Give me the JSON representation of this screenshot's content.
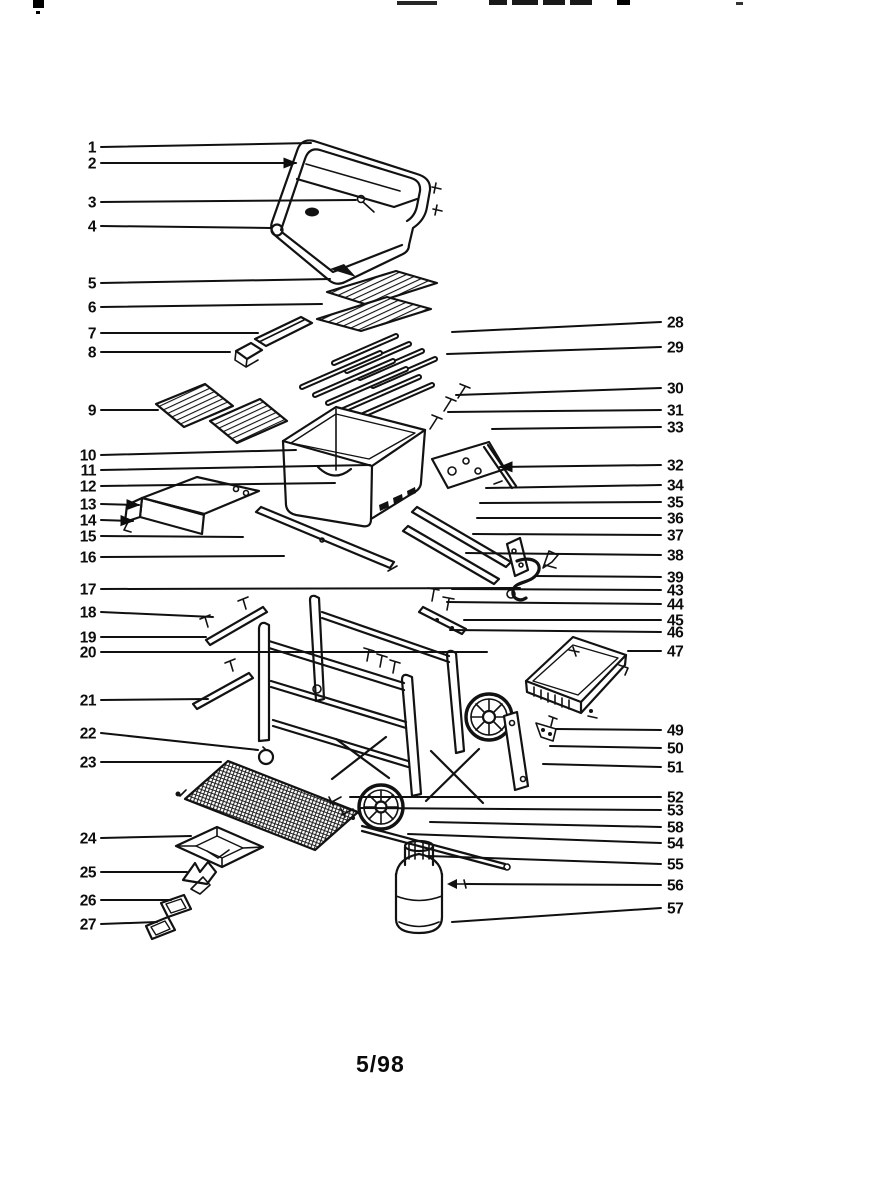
{
  "meta": {
    "caption": "5/98"
  },
  "diagram": {
    "type": "exploded-parts-diagram",
    "subject": "gas grill",
    "ink_color": "#121212",
    "background_color": "#ffffff",
    "callouts": [
      {
        "label": "1",
        "side": "left",
        "y": 147,
        "ex": 311,
        "ey": 143
      },
      {
        "label": "2",
        "side": "left",
        "y": 163,
        "ex": 296,
        "ey": 163,
        "arrow": true
      },
      {
        "label": "3",
        "side": "left",
        "y": 202,
        "ex": 356,
        "ey": 200
      },
      {
        "label": "4",
        "side": "left",
        "y": 226,
        "ex": 271,
        "ey": 228
      },
      {
        "label": "5",
        "side": "left",
        "y": 283,
        "ex": 330,
        "ey": 279
      },
      {
        "label": "6",
        "side": "left",
        "y": 307,
        "ex": 322,
        "ey": 304
      },
      {
        "label": "7",
        "side": "left",
        "y": 333,
        "ex": 258,
        "ey": 333
      },
      {
        "label": "8",
        "side": "left",
        "y": 352,
        "ex": 230,
        "ey": 352
      },
      {
        "label": "9",
        "side": "left",
        "y": 410,
        "ex": 158,
        "ey": 410
      },
      {
        "label": "10",
        "side": "left",
        "y": 455,
        "ex": 296,
        "ey": 450
      },
      {
        "label": "11",
        "side": "left",
        "y": 470,
        "ex": 370,
        "ey": 465
      },
      {
        "label": "12",
        "side": "left",
        "y": 486,
        "ex": 335,
        "ey": 483
      },
      {
        "label": "13",
        "side": "left",
        "y": 504,
        "ex": 139,
        "ey": 505,
        "arrow": true
      },
      {
        "label": "14",
        "side": "left",
        "y": 520,
        "ex": 133,
        "ey": 521,
        "arrow": true
      },
      {
        "label": "15",
        "side": "left",
        "y": 536,
        "ex": 243,
        "ey": 537
      },
      {
        "label": "16",
        "side": "left",
        "y": 557,
        "ex": 284,
        "ey": 556
      },
      {
        "label": "17",
        "side": "left",
        "y": 589,
        "ex": 520,
        "ey": 588
      },
      {
        "label": "18",
        "side": "left",
        "y": 612,
        "ex": 213,
        "ey": 617
      },
      {
        "label": "19",
        "side": "left",
        "y": 637,
        "ex": 206,
        "ey": 637
      },
      {
        "label": "20",
        "side": "left",
        "y": 652,
        "ex": 487,
        "ey": 652
      },
      {
        "label": "21",
        "side": "left",
        "y": 700,
        "ex": 208,
        "ey": 699
      },
      {
        "label": "22",
        "side": "left",
        "y": 733,
        "ex": 258,
        "ey": 750
      },
      {
        "label": "23",
        "side": "left",
        "y": 762,
        "ex": 221,
        "ey": 762
      },
      {
        "label": "24",
        "side": "left",
        "y": 838,
        "ex": 191,
        "ey": 836
      },
      {
        "label": "25",
        "side": "left",
        "y": 872,
        "ex": 187,
        "ey": 872
      },
      {
        "label": "26",
        "side": "left",
        "y": 900,
        "ex": 171,
        "ey": 900
      },
      {
        "label": "27",
        "side": "left",
        "y": 924,
        "ex": 157,
        "ey": 922
      },
      {
        "label": "28",
        "side": "right",
        "y": 322,
        "ex": 452,
        "ey": 332
      },
      {
        "label": "29",
        "side": "right",
        "y": 347,
        "ex": 447,
        "ey": 354
      },
      {
        "label": "30",
        "side": "right",
        "y": 388,
        "ex": 456,
        "ey": 395
      },
      {
        "label": "31",
        "side": "right",
        "y": 410,
        "ex": 448,
        "ey": 412
      },
      {
        "label": "33",
        "side": "right",
        "y": 427,
        "ex": 492,
        "ey": 429
      },
      {
        "label": "32",
        "side": "right",
        "y": 465,
        "ex": 500,
        "ey": 467,
        "arrow": true
      },
      {
        "label": "34",
        "side": "right",
        "y": 485,
        "ex": 486,
        "ey": 488
      },
      {
        "label": "35",
        "side": "right",
        "y": 502,
        "ex": 480,
        "ey": 503
      },
      {
        "label": "36",
        "side": "right",
        "y": 518,
        "ex": 477,
        "ey": 518
      },
      {
        "label": "37",
        "side": "right",
        "y": 535,
        "ex": 473,
        "ey": 534
      },
      {
        "label": "38",
        "side": "right",
        "y": 555,
        "ex": 466,
        "ey": 553
      },
      {
        "label": "39",
        "side": "right",
        "y": 577,
        "ex": 535,
        "ey": 576
      },
      {
        "label": "43",
        "side": "right",
        "y": 590,
        "ex": 452,
        "ey": 589
      },
      {
        "label": "44",
        "side": "right",
        "y": 604,
        "ex": 447,
        "ey": 602
      },
      {
        "label": "45",
        "side": "right",
        "y": 620,
        "ex": 464,
        "ey": 620
      },
      {
        "label": "46",
        "side": "right",
        "y": 632,
        "ex": 450,
        "ey": 630
      },
      {
        "label": "47",
        "side": "right",
        "y": 651,
        "ex": 628,
        "ey": 651
      },
      {
        "label": "49",
        "side": "right",
        "y": 730,
        "ex": 556,
        "ey": 729
      },
      {
        "label": "50",
        "side": "right",
        "y": 748,
        "ex": 550,
        "ey": 746
      },
      {
        "label": "51",
        "side": "right",
        "y": 767,
        "ex": 543,
        "ey": 764
      },
      {
        "label": "52",
        "side": "right",
        "y": 797,
        "ex": 350,
        "ey": 797
      },
      {
        "label": "53",
        "side": "right",
        "y": 810,
        "ex": 360,
        "ey": 808
      },
      {
        "label": "58",
        "side": "right",
        "y": 827,
        "ex": 430,
        "ey": 822
      },
      {
        "label": "54",
        "side": "right",
        "y": 843,
        "ex": 408,
        "ey": 834
      },
      {
        "label": "55",
        "side": "right",
        "y": 864,
        "ex": 428,
        "ey": 856
      },
      {
        "label": "56",
        "side": "right",
        "y": 885,
        "ex": 466,
        "ey": 884
      },
      {
        "label": "57",
        "side": "right",
        "y": 908,
        "ex": 452,
        "ey": 922
      }
    ]
  }
}
